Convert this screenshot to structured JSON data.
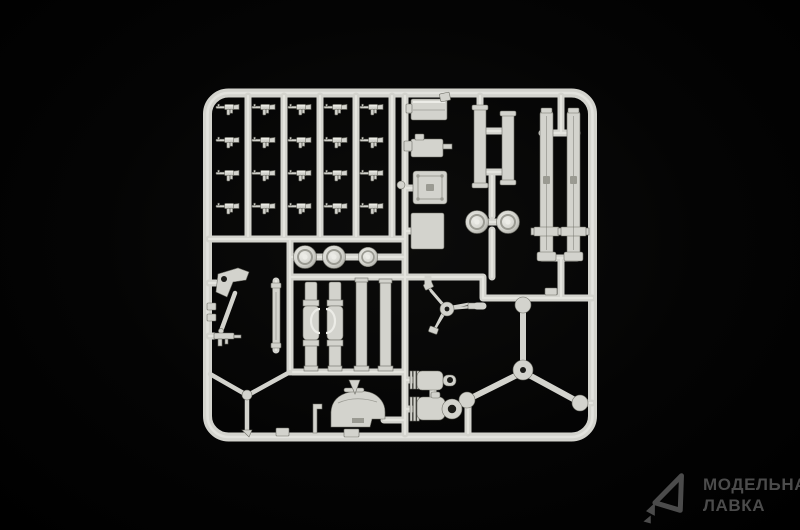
{
  "scene": {
    "subject": "photo of a light grey plastic model kit sprue on a black background",
    "colors": {
      "background": "#040404",
      "sprue": "#d3d3cd",
      "sprue_bright": "#ecece7",
      "sprue_shadow": "#9a9a92",
      "sprue_dark": "#6e6e66"
    }
  },
  "sprue": {
    "parts": [
      {
        "name": "rifles",
        "count": 20
      },
      {
        "name": "ammo-crate",
        "count": 1
      },
      {
        "name": "gun-receiver",
        "count": 1
      },
      {
        "name": "riveted-plate",
        "count": 1
      },
      {
        "name": "square-plate",
        "count": 1
      },
      {
        "name": "short-mortar-tubes",
        "count": 2
      },
      {
        "name": "wheel-pair",
        "count": 2
      },
      {
        "name": "long-mortar-barrels",
        "count": 2
      },
      {
        "name": "road-wheels",
        "count": 3
      },
      {
        "name": "support-tubes",
        "count": 4
      },
      {
        "name": "elevating-bracket",
        "count": 1
      },
      {
        "name": "flat-bar",
        "count": 1
      },
      {
        "name": "small-gun",
        "count": 1
      },
      {
        "name": "spoked-traverse",
        "count": 1
      },
      {
        "name": "large-tripod",
        "count": 1
      },
      {
        "name": "bipod",
        "count": 1
      },
      {
        "name": "dome-baseplate",
        "count": 1
      },
      {
        "name": "recoil-cylinders",
        "count": 2
      }
    ]
  },
  "watermark": {
    "logo_icon": "model-lavka-arrow-logo",
    "line1": "МОДЕЛЬНАЯ",
    "line2": "ЛАВКА",
    "color": "#4b4b4b"
  }
}
